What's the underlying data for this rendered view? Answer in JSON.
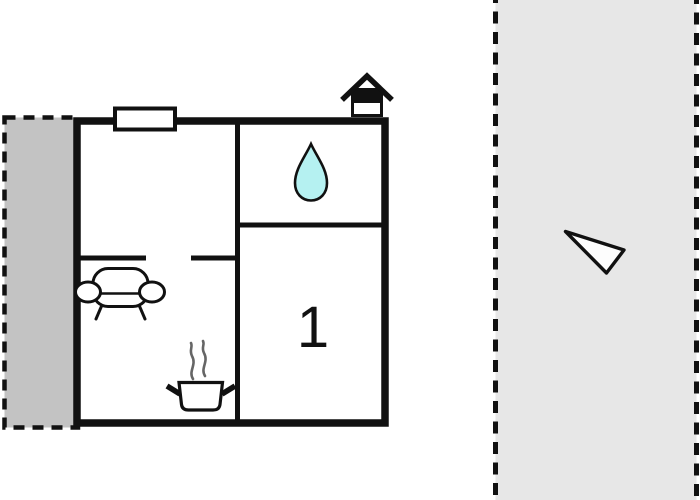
{
  "title": "Holiday home floor plan",
  "floorplan": {
    "room_label": "1",
    "rooms": {
      "bedroom_1": "1",
      "bathroom": "water-drop",
      "living_area": "sofa",
      "kitchen": "stove"
    },
    "icons": {
      "house": "house-icon",
      "water_drop": "water-drop-icon",
      "sofa": "sofa-icon",
      "stove": "stove-icon",
      "window": "window-marker",
      "north_arrow": "north-arrow-icon"
    },
    "colors": {
      "wall": "#111111",
      "room_fill": "#ffffff",
      "left_terrace_fill": "#c3c3c3",
      "right_area_fill": "#e7e7e7",
      "water_drop_fill": "#b5f1f1",
      "steam_stroke": "#666666"
    }
  }
}
